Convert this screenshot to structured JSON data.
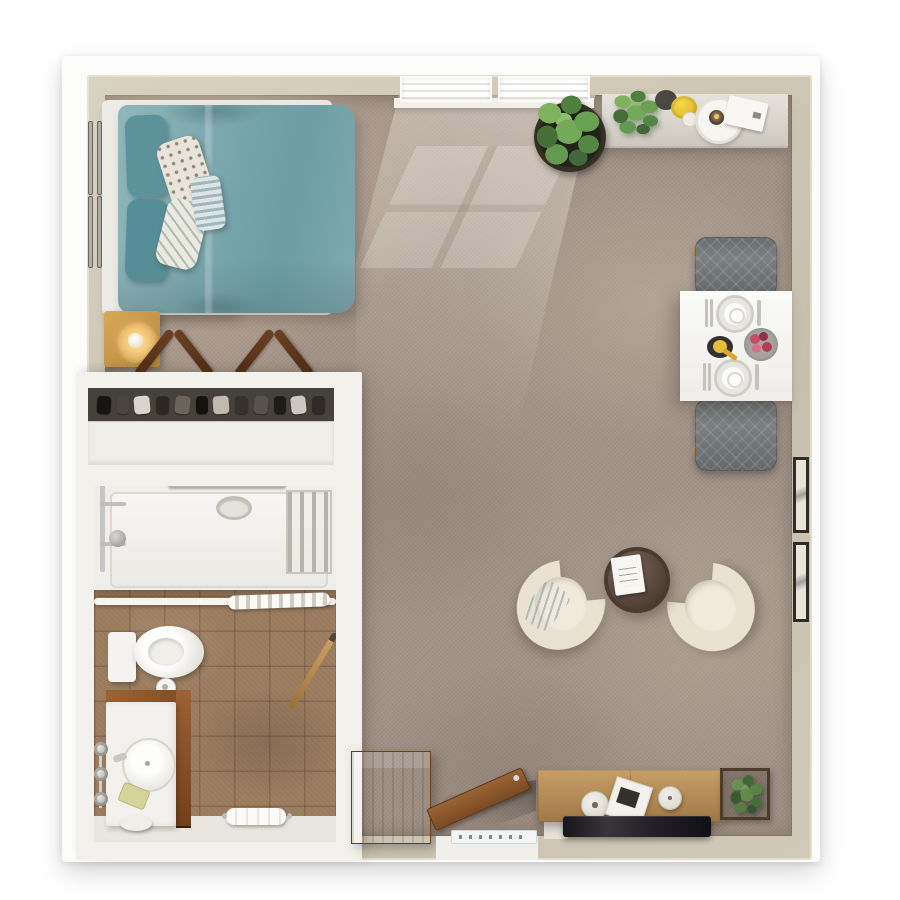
{
  "scene": {
    "type": "studio-apartment-floor-plan-render",
    "view": "top-down-3d",
    "rooms": [
      {
        "name": "bedroom",
        "items": [
          "double-bed",
          "headboard",
          "teal-duvet",
          "teal-pillows",
          "dotted-pillow",
          "leaf-pillow",
          "striped-bolster",
          "nightstand",
          "table-lamp",
          "wall-frames",
          "valet-stand",
          "valet-stand"
        ]
      },
      {
        "name": "closet",
        "items": [
          "hanging-clothes",
          "closet-shelf"
        ]
      },
      {
        "name": "bathroom",
        "items": [
          "bathtub",
          "tub-drain",
          "towel-bar",
          "shower-caddy",
          "shower-fixture",
          "shower-curtain",
          "toilet",
          "toilet-paper-roll",
          "vanity",
          "sink",
          "faucet",
          "wall-knobs",
          "soap-dish",
          "stool",
          "towel",
          "broom",
          "tile-floor"
        ]
      },
      {
        "name": "living-area",
        "items": [
          "windows",
          "console-table",
          "console-plant",
          "dark-bowl",
          "yellow-bowl",
          "cup",
          "candle-tray",
          "book",
          "floor-plant",
          "dining-table",
          "dining-chair",
          "dining-chair",
          "place-setting",
          "place-setting",
          "fruit-bowl",
          "flower-plate",
          "armchair",
          "armchair",
          "armchair-pillow",
          "coffee-table",
          "coffee-table-book",
          "media-console",
          "media-knobs",
          "magazine-stack",
          "tv",
          "boxed-plant",
          "dresser",
          "entry-door",
          "door-mat",
          "wall-frames"
        ]
      }
    ],
    "colors": {
      "page": "#ffffff",
      "wall": "#cbc3b1",
      "wall-light": "#e9e4d4",
      "block-wall": "#f3f1ec",
      "carpet": "#a29388",
      "carpet-light": "#c3b2a0",
      "bedroom-carpet": "#bfae97",
      "tile": "#9a7b5e",
      "fixture-white": "#f1efea",
      "teal": "#7aa7ad",
      "teal-dark": "#5d929b",
      "oak": "#c79e66",
      "walnut": "#5f3a20",
      "dresser-wood": "#a55f2e",
      "door-wood": "#8a5733",
      "tv-black": "#1f1c20",
      "chair-gray": "#7b8082",
      "cream": "#e9e2d3",
      "table-white": "#f7f6f4",
      "coffee-table-brown": "#55453b",
      "plant-green": "#5d9448",
      "plant-green-dark": "#3f6d33",
      "accent-yellow": "#e5bf3a",
      "accent-pink": "#c54e68",
      "chrome": "#c6c6c4",
      "mat-blue": "#cfd9e0",
      "lamp-glow": "#ffd98c"
    }
  }
}
